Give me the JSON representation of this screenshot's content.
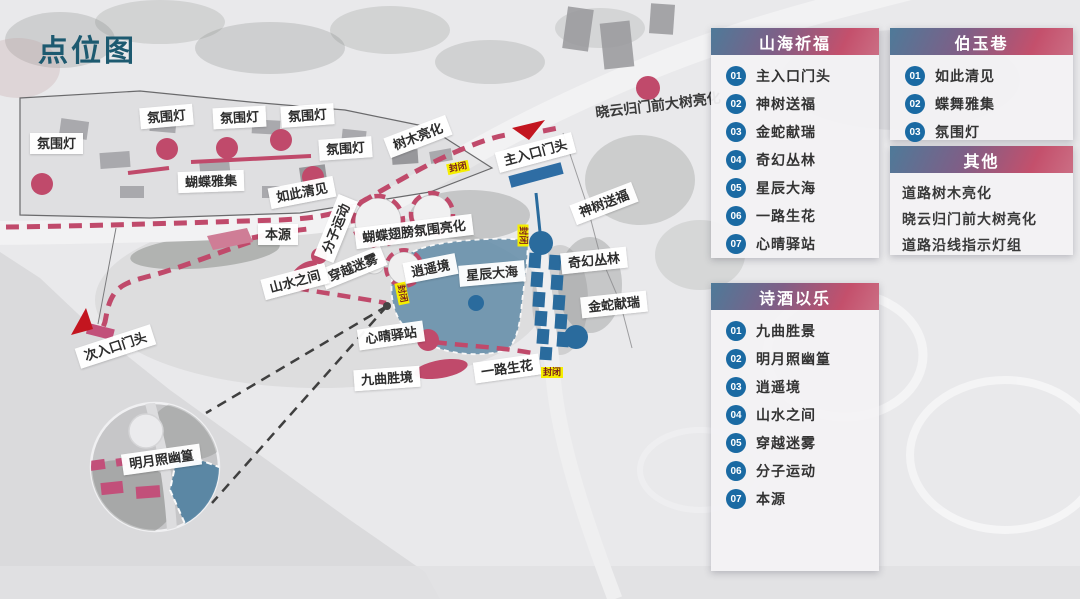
{
  "title": "点位图",
  "legend_panels": {
    "shanhai": {
      "title": "山海祈福",
      "items": [
        {
          "num": "01",
          "label": "主入口门头"
        },
        {
          "num": "02",
          "label": "神树送福"
        },
        {
          "num": "03",
          "label": "金蛇献瑞"
        },
        {
          "num": "04",
          "label": "奇幻丛林"
        },
        {
          "num": "05",
          "label": "星辰大海"
        },
        {
          "num": "06",
          "label": "一路生花"
        },
        {
          "num": "07",
          "label": "心晴驿站"
        }
      ]
    },
    "boyu": {
      "title": "伯玉巷",
      "items": [
        {
          "num": "01",
          "label": "如此清见"
        },
        {
          "num": "02",
          "label": "蝶舞雅集"
        },
        {
          "num": "03",
          "label": "氛围灯"
        }
      ]
    },
    "qita": {
      "title": "其他",
      "items": [
        {
          "label": "道路树木亮化"
        },
        {
          "label": "晓云归门前大树亮化"
        },
        {
          "label": "道路沿线指示灯组"
        }
      ]
    },
    "shijiu": {
      "title": "诗酒以乐",
      "items": [
        {
          "num": "01",
          "label": "九曲胜景"
        },
        {
          "num": "02",
          "label": "明月照幽篁"
        },
        {
          "num": "03",
          "label": "逍遥境"
        },
        {
          "num": "04",
          "label": "山水之间"
        },
        {
          "num": "05",
          "label": "穿越迷雾"
        },
        {
          "num": "06",
          "label": "分子运动"
        },
        {
          "num": "07",
          "label": "本源"
        }
      ]
    }
  },
  "map": {
    "closed_tag": "封闭",
    "labels": [
      {
        "text": "氛围灯"
      },
      {
        "text": "氛围灯"
      },
      {
        "text": "氛围灯"
      },
      {
        "text": "氛围灯"
      },
      {
        "text": "氛围灯"
      },
      {
        "text": "蝴蝶雅集"
      },
      {
        "text": "如此清见"
      },
      {
        "text": "树木亮化"
      },
      {
        "text": "主入口门头"
      },
      {
        "text": "晓云归门前大树亮化"
      },
      {
        "text": "神树送福"
      },
      {
        "text": "奇幻丛林"
      },
      {
        "text": "金蛇献瑞"
      },
      {
        "text": "星辰大海"
      },
      {
        "text": "逍遥境"
      },
      {
        "text": "穿越迷雾"
      },
      {
        "text": "蝴蝶翅膀氛围亮化"
      },
      {
        "text": "分子运动"
      },
      {
        "text": "本源"
      },
      {
        "text": "山水之间"
      },
      {
        "text": "心晴驿站"
      },
      {
        "text": "九曲胜境"
      },
      {
        "text": "一路生花"
      },
      {
        "text": "次入口门头"
      },
      {
        "text": "明月照幽篁"
      }
    ],
    "colors": {
      "accent_pink": "#c04a6b",
      "accent_blue": "#2a6b9d",
      "accent_red": "#c3151f",
      "badge_blue": "#1a6aa3",
      "title_teal": "#1d5a70",
      "lake_blue": "#5b87a5",
      "closed_yellow": "#f5ee00",
      "header_gradient_start": "#4e7a99",
      "header_gradient_end": "#c4506c"
    }
  }
}
